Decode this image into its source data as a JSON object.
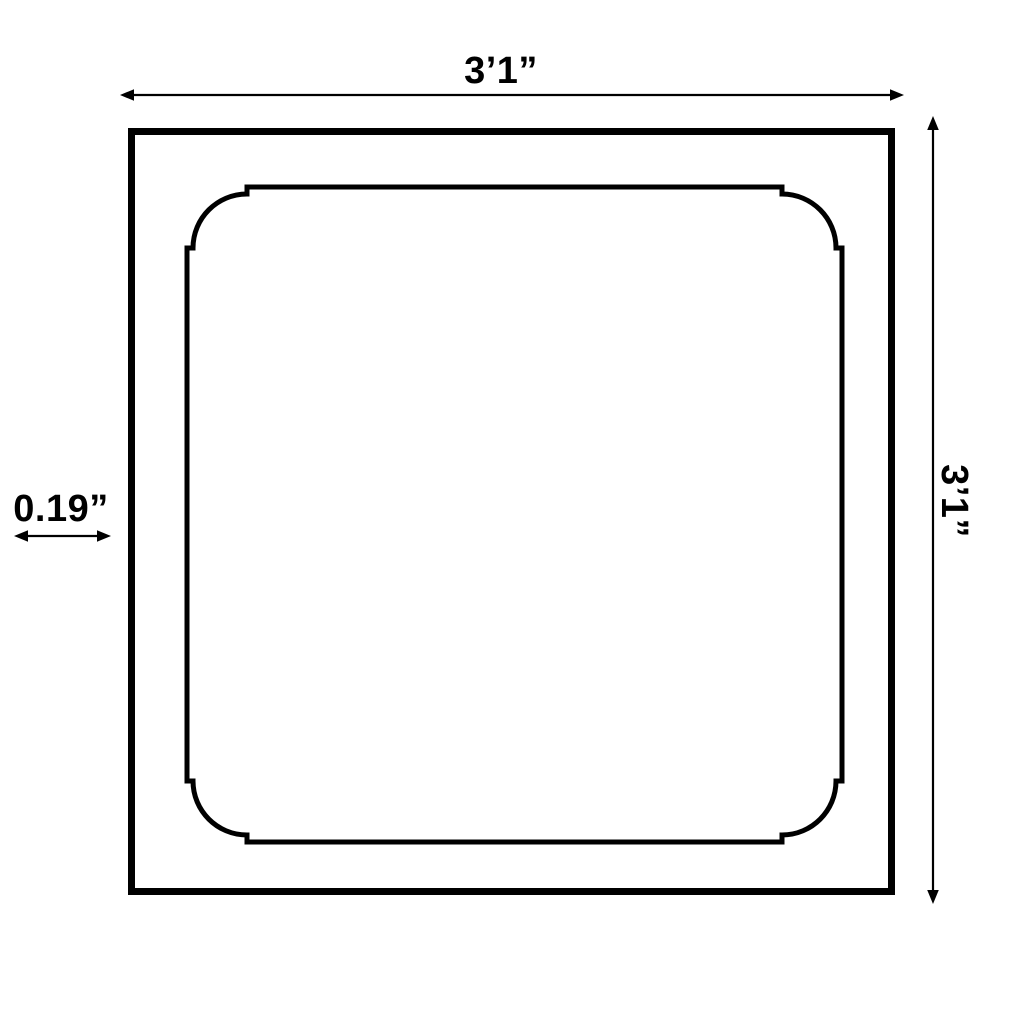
{
  "diagram": {
    "kind": "product-dimension-drawing",
    "shape": "square wall panel frame with concave quarter-round corner details",
    "labels": {
      "width": "3’1”",
      "height": "3’1”",
      "thickness": "0.19”"
    },
    "dimensions": {
      "width_value": "3'1\"",
      "height_value": "3'1\"",
      "thickness_value": "0.19\""
    },
    "colors": {
      "line": "#000000",
      "background": "#ffffff"
    }
  }
}
